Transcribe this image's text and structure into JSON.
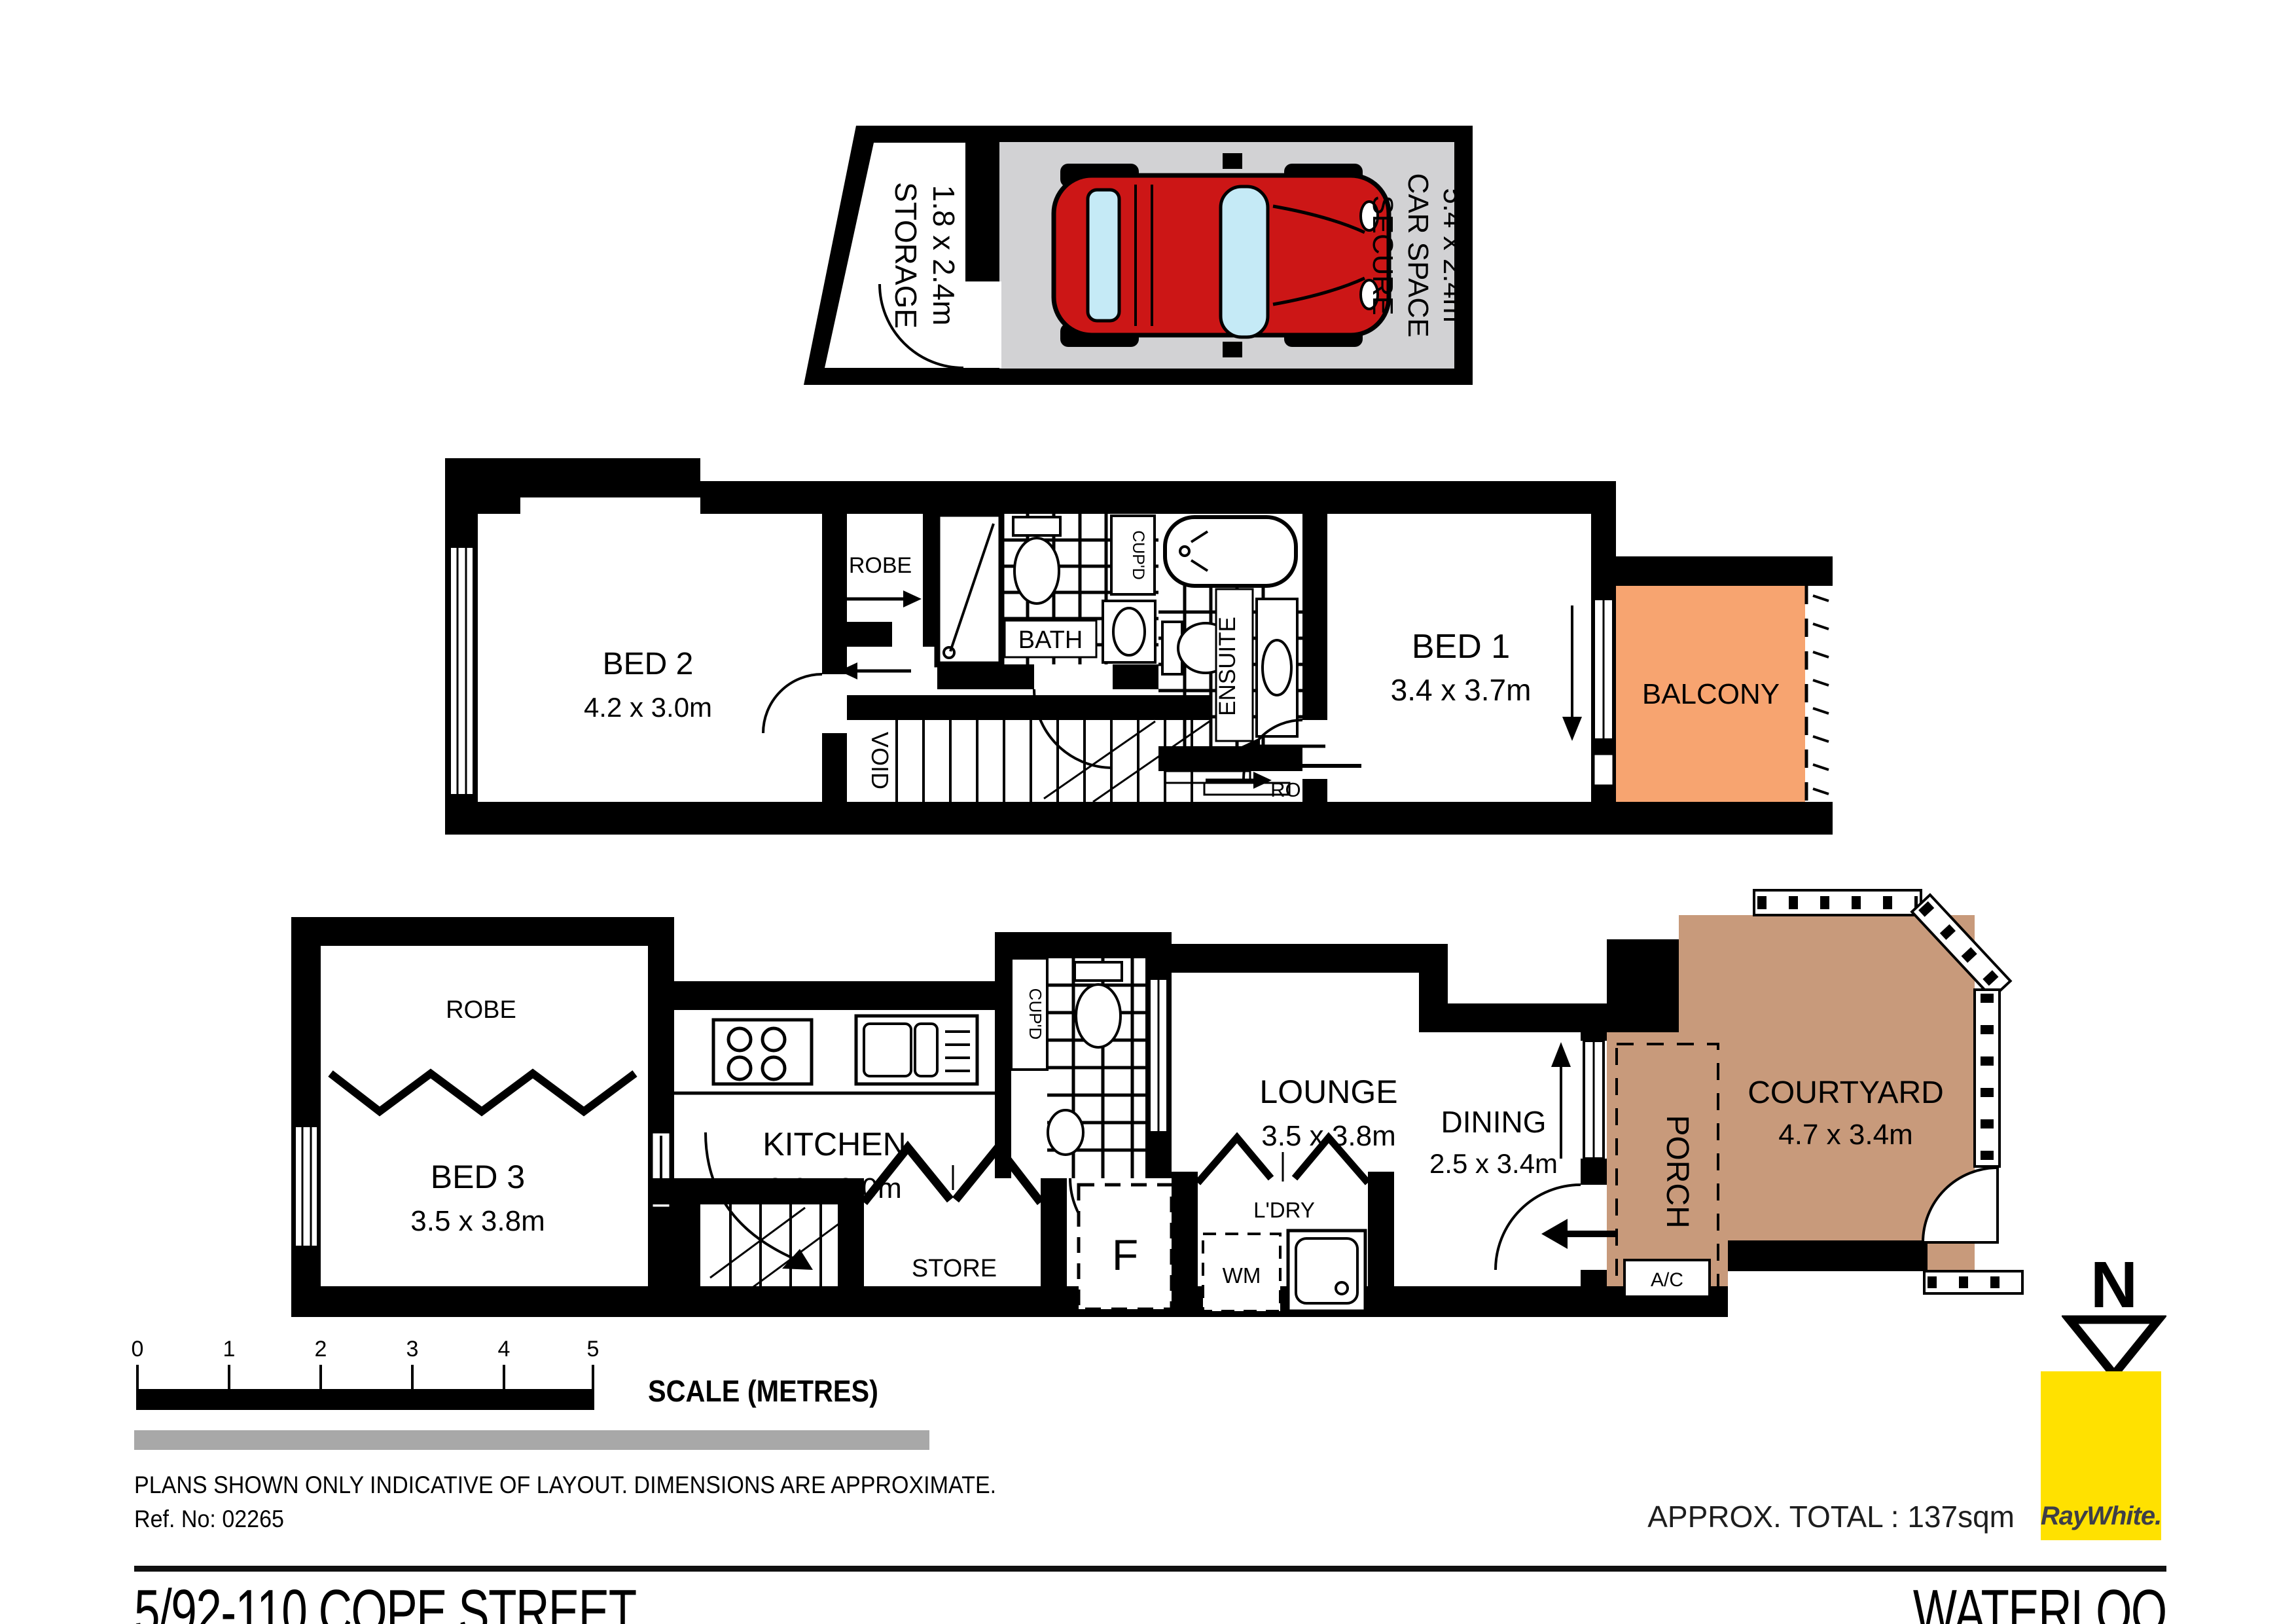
{
  "title": {
    "address": "5/92-110 COPE STREET",
    "suburb": "WATERLOO"
  },
  "branding": {
    "agency": "RayWhite.",
    "logo_color": "#FFE100"
  },
  "north_indicator": "N",
  "summary": {
    "approx_total": "APPROX. TOTAL : 137sqm"
  },
  "scale_bar": {
    "title": "SCALE (METRES)",
    "ticks": [
      "0",
      "1",
      "2",
      "3",
      "4",
      "5"
    ]
  },
  "disclaimer": {
    "line1": "PLANS SHOWN ONLY INDICATIVE OF LAYOUT.  DIMENSIONS ARE APPROXIMATE.",
    "ref": "Ref. No: 02265"
  },
  "garage": {
    "storage": {
      "name": "STORAGE",
      "dims": "1.8 x 2.4m"
    },
    "car_space": {
      "line1": "SECURE",
      "line2": "CAR SPACE",
      "dims": "5.4 x 2.4m"
    }
  },
  "upper_floor": {
    "bed2": {
      "name": "BED 2",
      "dims": "4.2 x 3.0m"
    },
    "robe2": "ROBE",
    "bath": "BATH",
    "cupd": "CUP'D",
    "ensuite": "ENSUITE",
    "bed1": {
      "name": "BED 1",
      "dims": "3.4 x 3.7m"
    },
    "balcony": "BALCONY",
    "void": "VOID",
    "robe1": "ROBE"
  },
  "lower_floor": {
    "robe3": "ROBE",
    "bed3": {
      "name": "BED 3",
      "dims": "3.5 x 3.8m"
    },
    "kitchen": {
      "name": "KITCHEN",
      "dims": "3.6 x 3.0m"
    },
    "cupd": "CUP'D",
    "wc": "WC",
    "store": "STORE",
    "fridge": "F",
    "laundry": "L'DRY",
    "wm": "WM",
    "lounge": {
      "name": "LOUNGE",
      "dims": "3.5 x 3.8m"
    },
    "dining": {
      "name": "DINING",
      "dims": "2.5 x 3.4m"
    },
    "porch": "PORCH",
    "ac": "A/C",
    "courtyard": {
      "name": "COURTYARD",
      "dims": "4.7 x 3.4m"
    }
  },
  "colors": {
    "balcony": "#F7A470",
    "courtyard": "#C89A7B",
    "car_space_bg": "#D2D2D4",
    "car_body": "#CC1616",
    "car_glass": "#C5EAF6",
    "ray_white_yellow": "#FFE100"
  }
}
